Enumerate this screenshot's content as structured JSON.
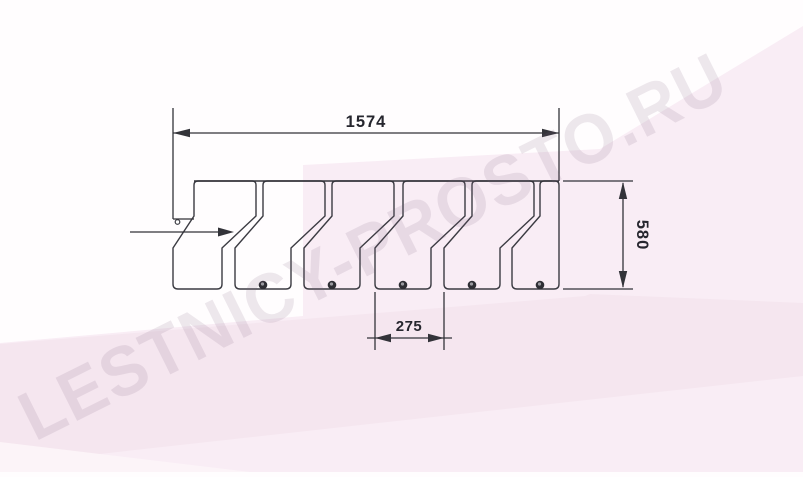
{
  "watermark": {
    "text": "LESTNICY-PROSTO.RU",
    "color": "rgba(128,98,128,0.14)"
  },
  "drawing": {
    "type": "technical-drawing",
    "subject": "alternating-tread staircase plan view",
    "dimensions": {
      "total_length": "1574",
      "depth": "580",
      "pitch": "275"
    },
    "tread_count": 6,
    "bolt_count": 5,
    "entry_arrow": "left-to-right",
    "colors": {
      "line": "#3b3b42",
      "dim_line": "#333339",
      "text": "#26262e",
      "bolt": "#2e2e34",
      "bolt_center": "#9a9aa0",
      "pink_light": "#f9edf5",
      "pink_mid": "#f5e6ef",
      "pink_pale": "#fcf4f8"
    }
  }
}
